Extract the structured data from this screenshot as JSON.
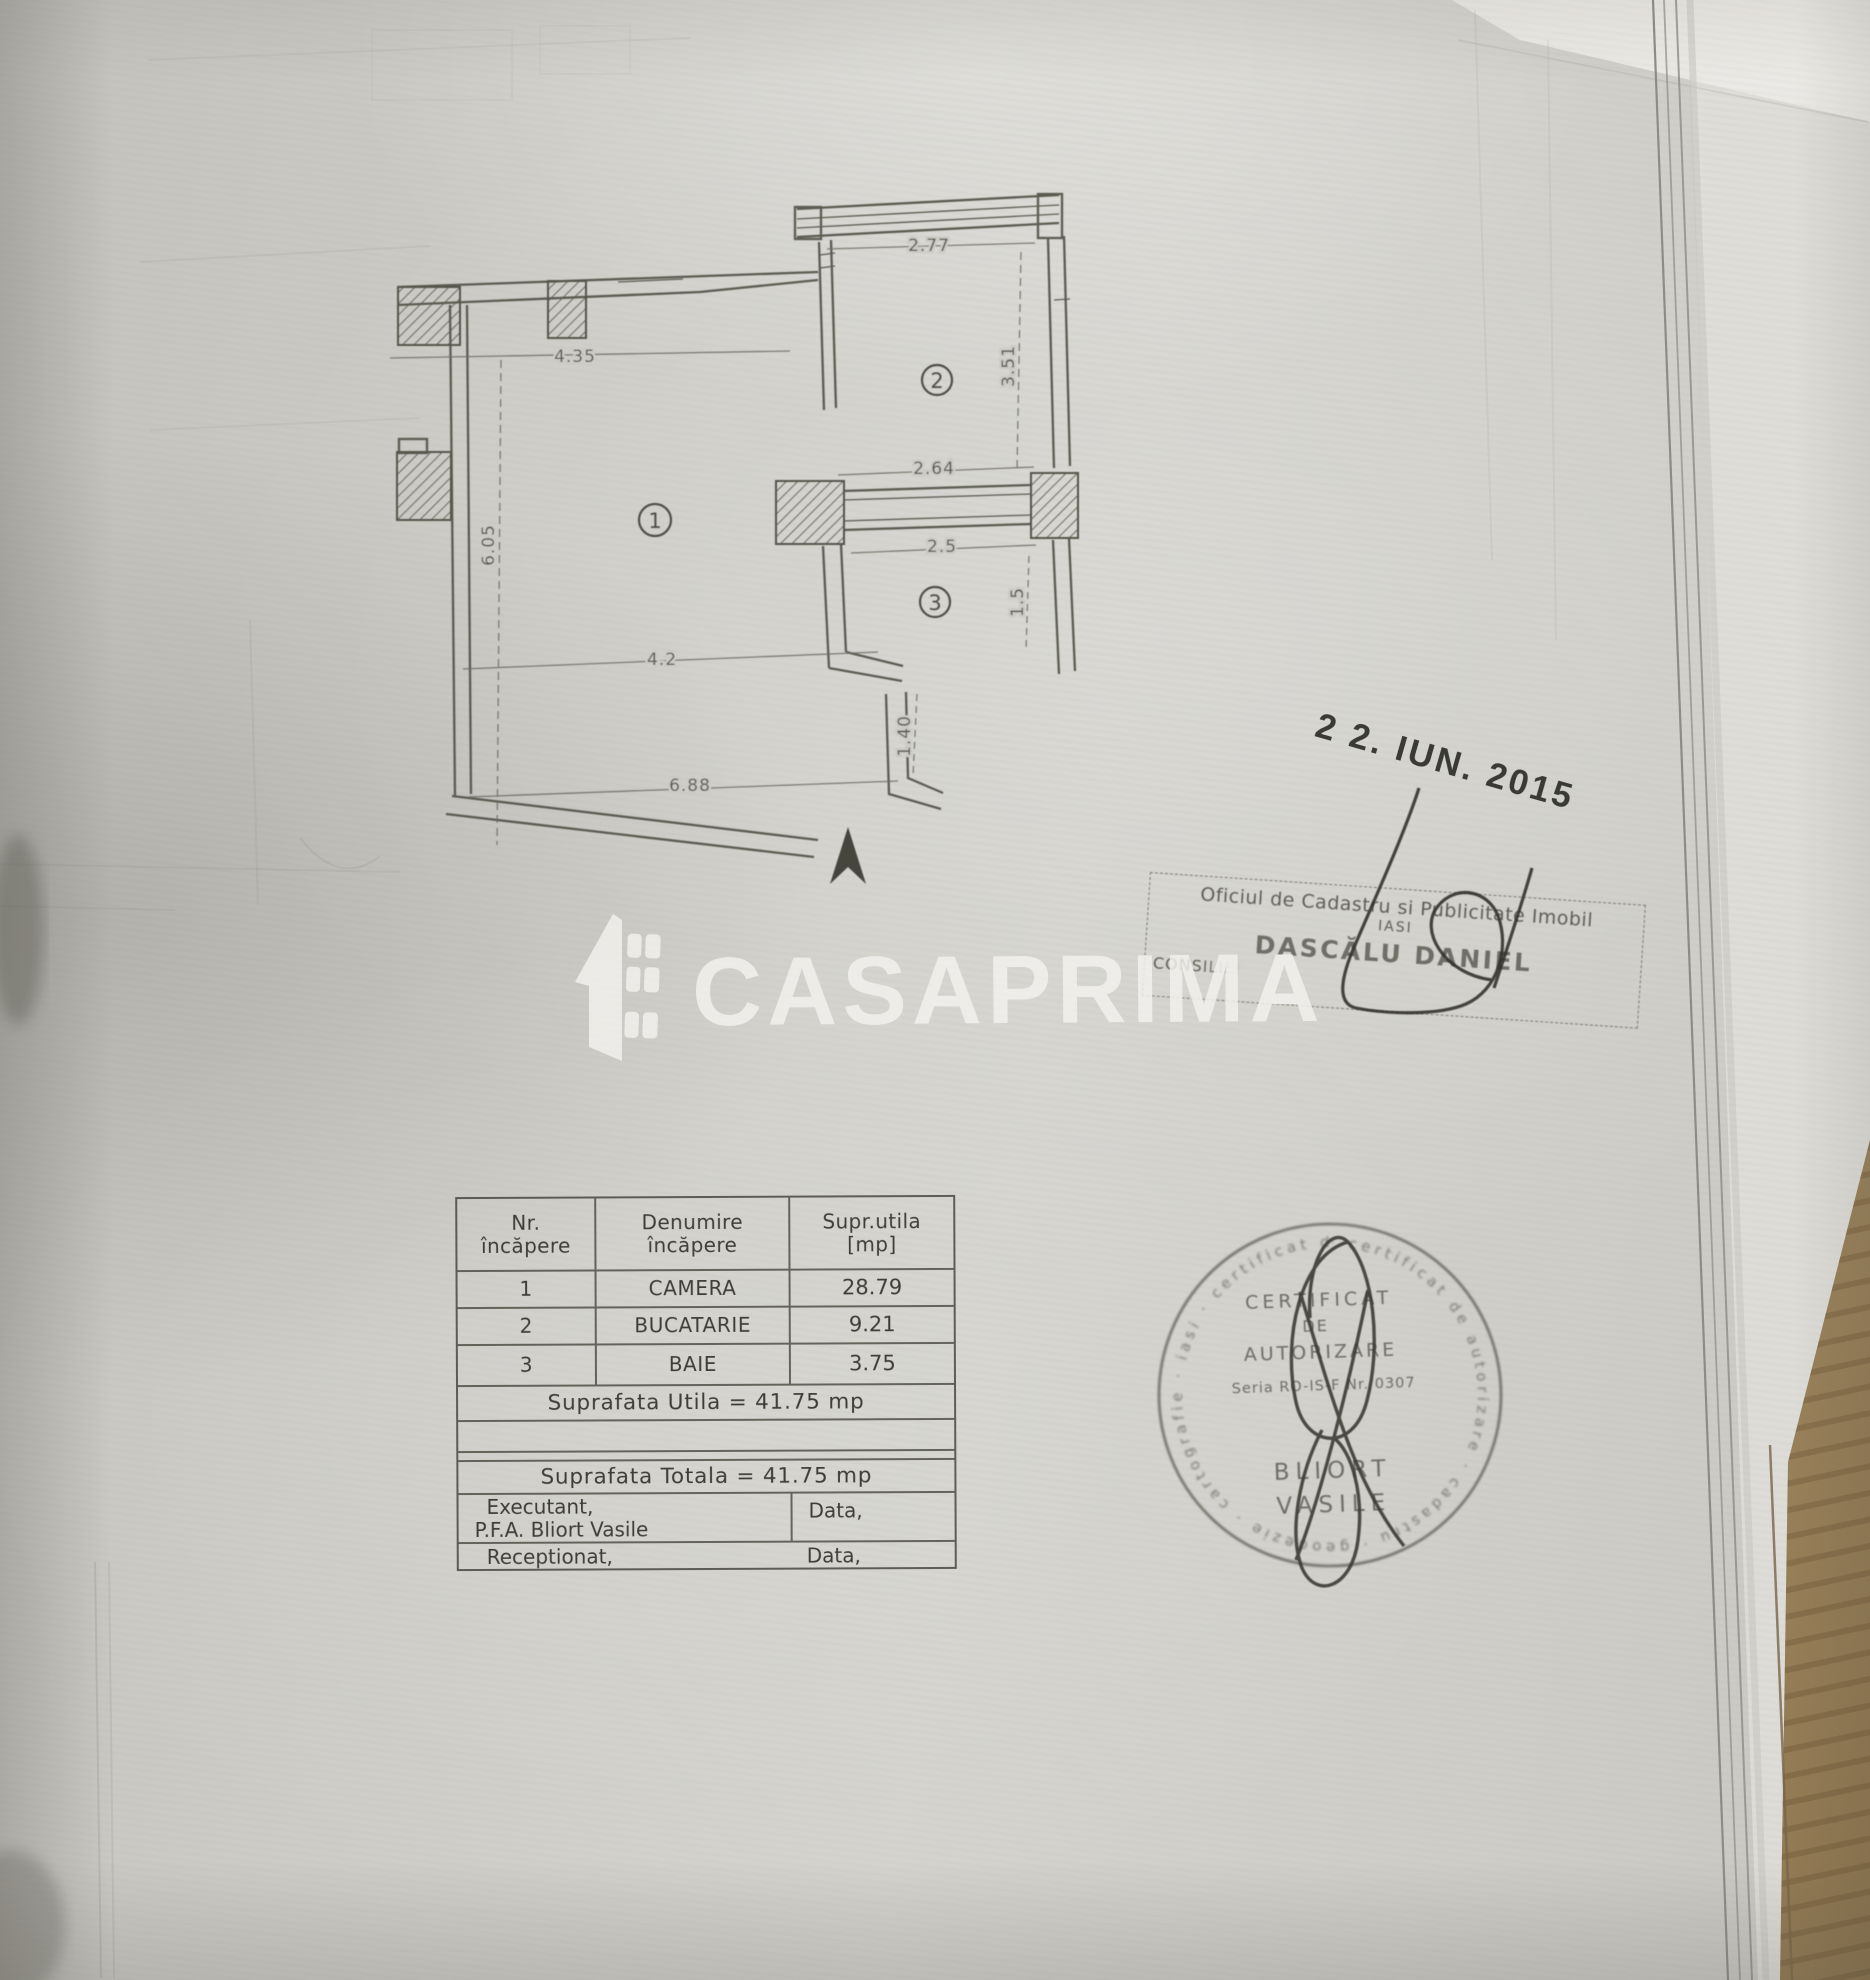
{
  "watermark": {
    "brand": "CASAPRIMA"
  },
  "stamps": {
    "date": "2 2. IUN. 2015",
    "registry": {
      "line1": "Oficiul de Cadastru si Publicitate Imobil",
      "line2": "IASI",
      "name": "DASCĂLU DANIEL",
      "side": "CONSILIER"
    },
    "round": {
      "line1": "CERTIFICAT",
      "line2": "DE",
      "line3": "AUTORIZARE",
      "line4": "Seria RO-IS-F Nr. 0307",
      "name1": "BLIORT",
      "name2": "VASILE",
      "rim_text": "· certificat de autorizare · cadastru · geodezie · cartografie · iasi · certificat de autorizare ·"
    }
  },
  "plan": {
    "rooms": [
      {
        "number": "1"
      },
      {
        "number": "2"
      },
      {
        "number": "3"
      }
    ],
    "dimensions": [
      {
        "id": "camera-top-width",
        "label": "4.35"
      },
      {
        "id": "camera-left-height",
        "label": "6.05"
      },
      {
        "id": "camera-bottom-width",
        "label": "4.2"
      },
      {
        "id": "bucatarie-top-width",
        "label": "2.77"
      },
      {
        "id": "bucatarie-right-height",
        "label": "3.51"
      },
      {
        "id": "hall-width",
        "label": "2.64"
      },
      {
        "id": "baie-width",
        "label": "2.5"
      },
      {
        "id": "baie-right-height",
        "label": "1.5"
      },
      {
        "id": "door-right-height",
        "label": "1.40"
      },
      {
        "id": "bottom-total-width",
        "label": "6.88"
      }
    ]
  },
  "table": {
    "headers": {
      "col1a": "Nr.",
      "col1b": "încăpere",
      "col2": "Denumire încăpere",
      "col3a": "Supr.utila",
      "col3b": "[mp]"
    },
    "rows": [
      {
        "nr": "1",
        "name": "CAMERA",
        "area": "28.79"
      },
      {
        "nr": "2",
        "name": "BUCATARIE",
        "area": "9.21"
      },
      {
        "nr": "3",
        "name": "BAIE",
        "area": "3.75"
      }
    ],
    "total_utila": "Suprafata Utila = 41.75 mp",
    "total_totala": "Suprafata Totala = 41.75 mp",
    "executant_label": "Executant,",
    "executant_name": "P.F.A. Bliort Vasile",
    "data_label1": "Data,",
    "receptionat_label": "Receptionat,",
    "data_label2": "Data,"
  }
}
